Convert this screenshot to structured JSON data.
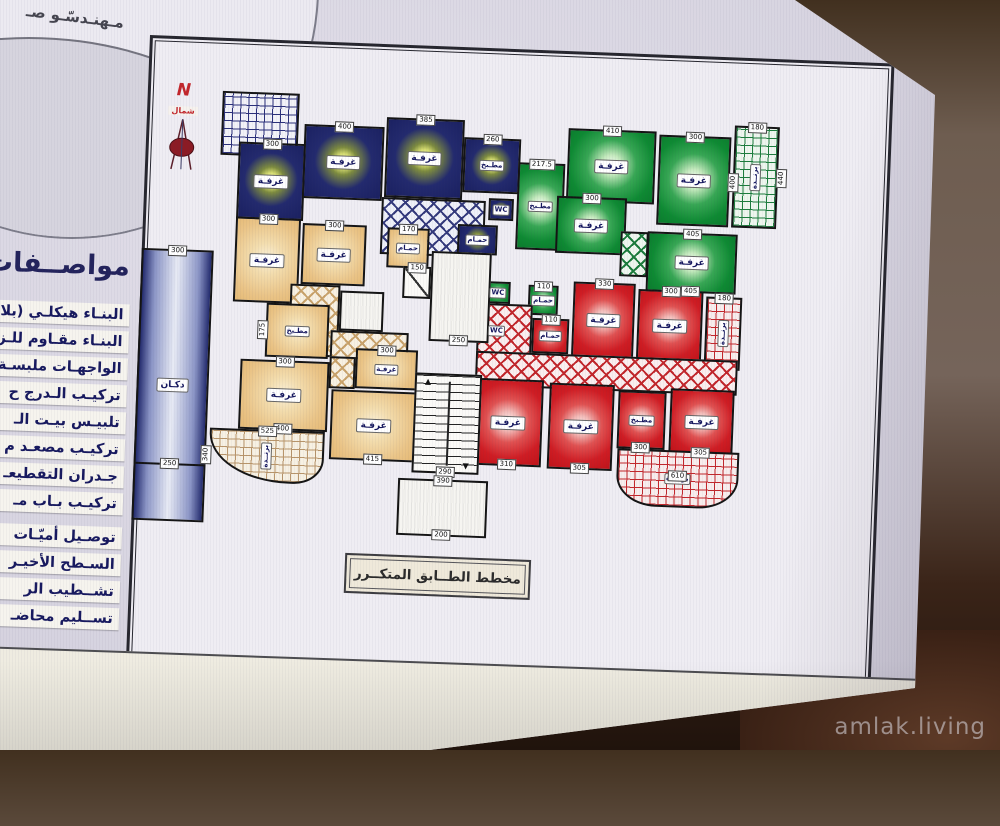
{
  "photo": {
    "watermark": "amlak.living"
  },
  "logo": {
    "text": "مـهنـدسّـو صـ"
  },
  "specs": {
    "heading": "مواصــفات ا",
    "items": [
      "البنـاء هيكلـي (بلا",
      "البنـاء مقـاوم للـز",
      "الواجهـات ملبسـة",
      "تركيـب الـدرج ح",
      "تلبيـس بيـت الـ",
      "تركيـب مصعـد م",
      "جـدران التقطيعـ",
      "تركيـب بـاب مـ",
      "توصـيل أميّـات",
      "السـطح الأخيـر",
      "تشــطيب الر",
      "تســليم محاضـ"
    ]
  },
  "north": {
    "letter": "N",
    "label": "شمال"
  },
  "title": "مخطط الطــابق المتكــرر",
  "labels": {
    "room": "غرفـة",
    "kitchen": "مطـبخ",
    "bath": "حمـام",
    "wc": "WC",
    "balcony": "برنــدة",
    "shop": "دكـان"
  },
  "dims": {
    "blue_r1": "300",
    "blue_r2": "400",
    "blue_r3": "385",
    "blue_kitchen": "260",
    "green_kitchen": "217.5",
    "green_r1": "410",
    "green_r2": "300",
    "green_r2b": "400",
    "green_bal_t": "180",
    "green_bal_r": "440",
    "green_r3": "300",
    "green_r4": "405",
    "green_r4b": "405",
    "green_bath": "110",
    "red_bath": "110",
    "red_r1": "330",
    "red_r2": "300",
    "red_bal_t": "180",
    "red_r3": "310",
    "red_r4": "305",
    "red_kitchen": "300",
    "red_r5": "305",
    "red_bal_b": "610",
    "or_r1": "300",
    "or_r2": "300",
    "or_bath": "170",
    "or_kitchen": "175",
    "or_r3": "300",
    "or_r3b": "400",
    "or_r4": "415",
    "or_r5": "300",
    "or_bal": "525",
    "or_bal_l": "340",
    "hall": "250",
    "stair": "290",
    "entry": "390",
    "entry_b": "200",
    "elevator": "150",
    "shop_t": "300",
    "shop_m": "250"
  },
  "apartment_colors": {
    "blue": "#232a6e",
    "green": "#0e8a33",
    "red": "#cf1d24",
    "orange": "#eac487"
  }
}
